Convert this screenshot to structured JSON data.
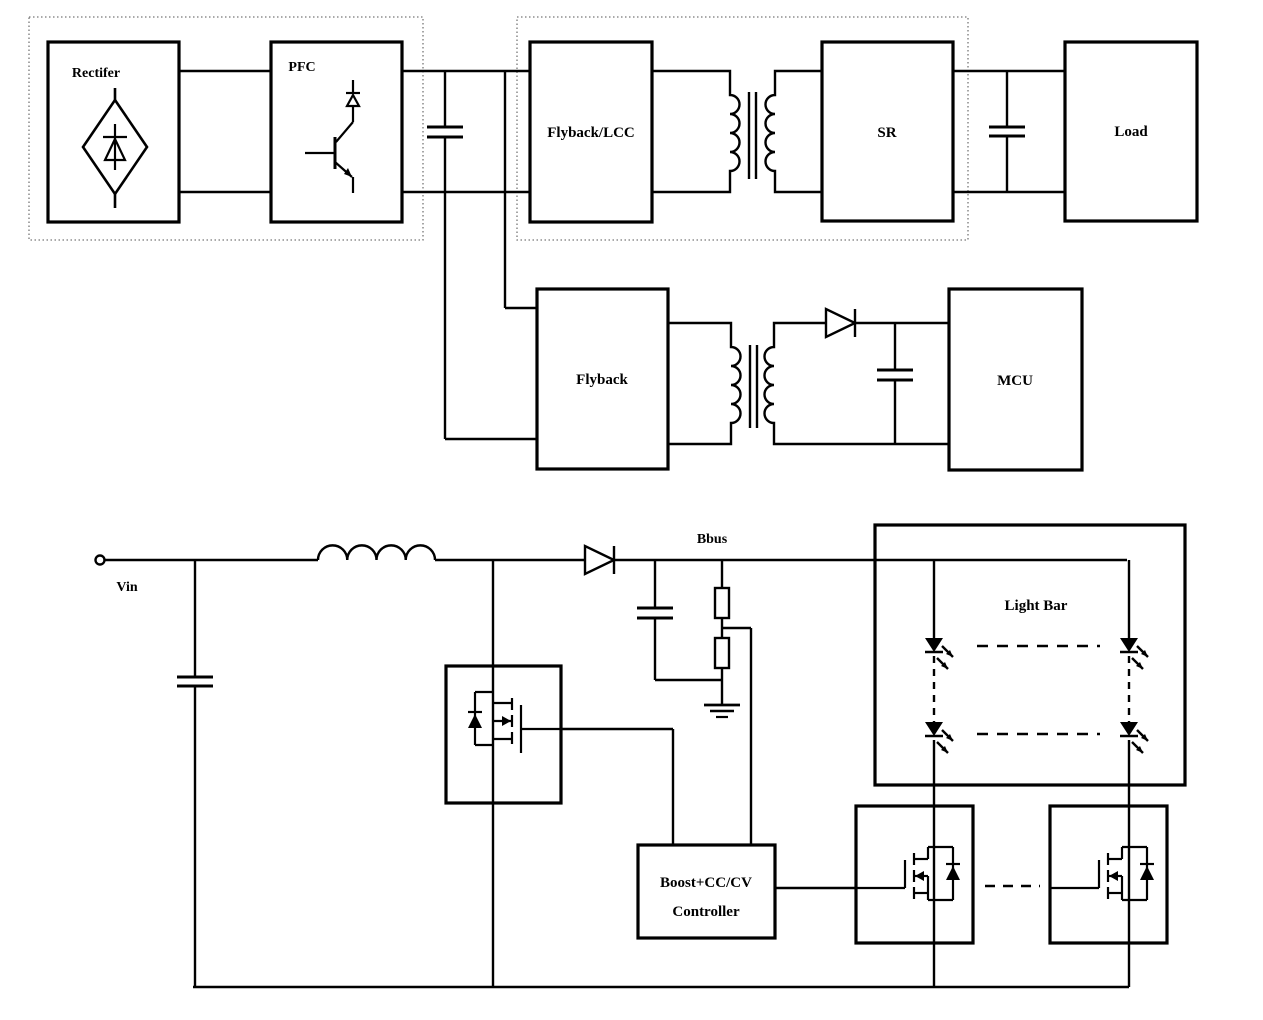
{
  "canvas": {
    "width": 1263,
    "height": 1020,
    "background": "#ffffff",
    "line_color": "#000000",
    "dotted_outline_color": "#777777"
  },
  "top_section": {
    "rectifier_label": "Rectifer",
    "pfc_label": "PFC",
    "flyback_lcc_label": "Flyback/LCC",
    "sr_label": "SR",
    "load_label": "Load"
  },
  "mid_section": {
    "flyback_label": "Flyback",
    "mcu_label": "MCU"
  },
  "bottom_section": {
    "vin_label": "Vin",
    "bbus_label": "Bbus",
    "light_bar_label": "Light Bar",
    "controller_label_line1": "Boost+CC/CV",
    "controller_label_line2": "Controller"
  },
  "icons": {
    "bridge_rectifier": "diode-in-diamond",
    "pfc_switch": "transistor-with-diode",
    "transformer": "coupled-coils-with-core",
    "capacitor": "parallel-plates",
    "inductor": "four-hump-coil",
    "diode": "triangle-with-bar",
    "led": "diode-with-emission-arrows",
    "mosfet": "n-mosfet-with-body-diode",
    "resistor": "rectangle",
    "ground": "three-line-earth",
    "input_terminal": "open-circle"
  }
}
